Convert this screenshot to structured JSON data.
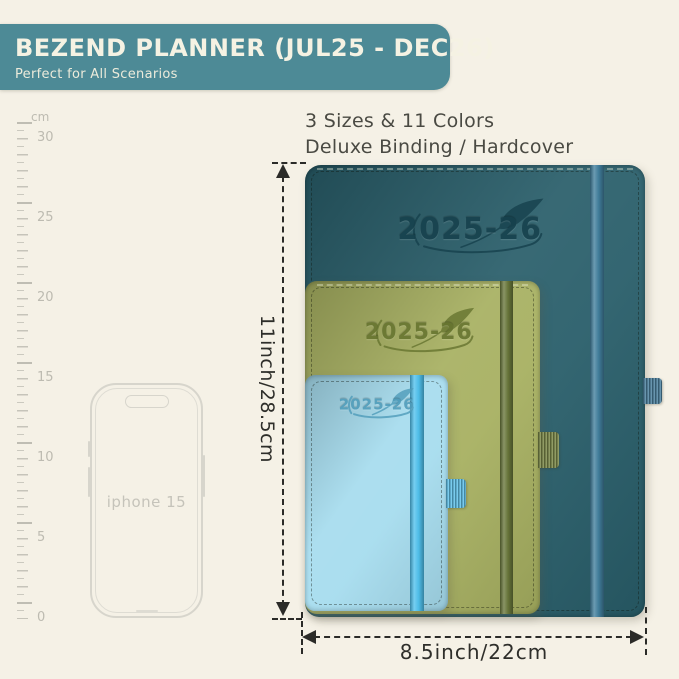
{
  "header": {
    "title": "BEZEND PLANNER (JUL25 - DEC26)",
    "subtitle": "Perfect for All Scenarios"
  },
  "features": {
    "line1": "3 Sizes & 11 Colors",
    "line2": "Deluxe Binding / Hardcover"
  },
  "ruler": {
    "unit": "cm",
    "labels": [
      "30",
      "25",
      "20",
      "15",
      "10",
      "5",
      "0"
    ]
  },
  "phone": {
    "label": "iphone 15"
  },
  "dimensions": {
    "height": "11inch/28.5cm",
    "width": "8.5inch/22cm"
  },
  "planners": [
    {
      "size": "large",
      "year": "2025-26",
      "cover_color": "#295e6a",
      "band_color": "#417e9c",
      "emboss_color": "#16414d",
      "loop_color": "#4e82a0"
    },
    {
      "size": "medium",
      "year": "2025-26",
      "cover_color": "#a7b061",
      "band_color": "#68763a",
      "emboss_color": "#66742f",
      "loop_color": "#7d8a4a"
    },
    {
      "size": "small",
      "year": "2025-26",
      "cover_color": "#a6dcee",
      "band_color": "#4fc0ec",
      "emboss_color": "#4f9cba",
      "loop_color": "#62c2ea"
    }
  ],
  "colors": {
    "background": "#f5f1e6",
    "banner": "#4d8a96",
    "banner_text": "#f5f2e3",
    "dimension_lines": "#2b2b28",
    "ruler_marks": "#c6c4ba"
  }
}
